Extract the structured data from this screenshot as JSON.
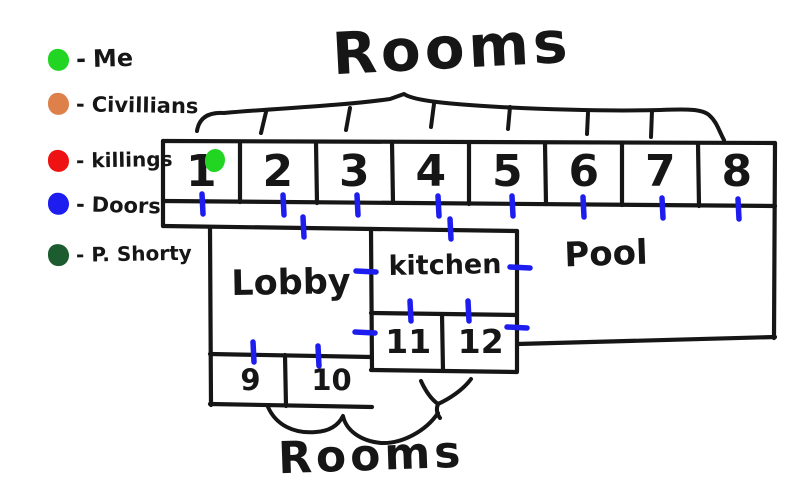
{
  "titles": {
    "top_rooms": "Rooms",
    "bottom_rooms": "Rooms"
  },
  "legend": {
    "separator": "-",
    "items": [
      {
        "id": "me",
        "label": "Me",
        "color": "#23d523"
      },
      {
        "id": "civillians",
        "label": "Civillians",
        "color": "#dd8049"
      },
      {
        "id": "killings",
        "label": "killings",
        "color": "#ee1212"
      },
      {
        "id": "doors",
        "label": "Doors",
        "color": "#1d1df0"
      },
      {
        "id": "p-shorty",
        "label": "P. Shorty",
        "color": "#1d5c2e"
      }
    ]
  },
  "map": {
    "rooms_top": [
      "1",
      "2",
      "3",
      "4",
      "5",
      "6",
      "7",
      "8"
    ],
    "rooms_bottom_left": [
      "9",
      "10"
    ],
    "rooms_bottom_mid": [
      "11",
      "12"
    ],
    "areas": {
      "lobby": "Lobby",
      "kitchen": "kitchen",
      "pool": "Pool"
    },
    "me_marker": {
      "room": "1",
      "color": "#23d523"
    },
    "doors": [
      {
        "x": 202,
        "y": 204,
        "o": "v"
      },
      {
        "x": 283,
        "y": 205,
        "o": "v"
      },
      {
        "x": 357,
        "y": 205,
        "o": "v"
      },
      {
        "x": 438,
        "y": 206,
        "o": "v"
      },
      {
        "x": 512,
        "y": 206,
        "o": "v"
      },
      {
        "x": 583,
        "y": 207,
        "o": "v"
      },
      {
        "x": 662,
        "y": 208,
        "o": "v"
      },
      {
        "x": 738,
        "y": 209,
        "o": "v"
      },
      {
        "x": 303,
        "y": 227,
        "o": "v"
      },
      {
        "x": 450,
        "y": 229,
        "o": "v"
      },
      {
        "x": 366,
        "y": 271,
        "o": "h"
      },
      {
        "x": 520,
        "y": 267,
        "o": "h"
      },
      {
        "x": 410,
        "y": 311,
        "o": "v"
      },
      {
        "x": 468,
        "y": 311,
        "o": "v"
      },
      {
        "x": 365,
        "y": 332,
        "o": "h"
      },
      {
        "x": 517,
        "y": 327,
        "o": "h"
      },
      {
        "x": 253,
        "y": 352,
        "o": "v"
      },
      {
        "x": 318,
        "y": 356,
        "o": "v"
      }
    ]
  },
  "colors": {
    "ink": "#161616",
    "door": "#1d1df0"
  }
}
